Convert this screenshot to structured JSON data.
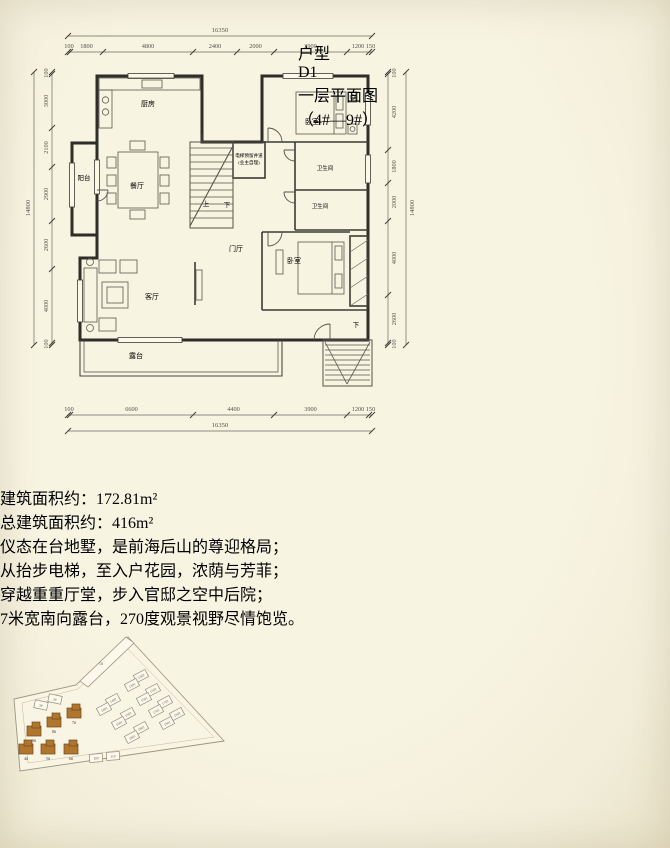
{
  "header": {
    "category": "户型",
    "unit": "D1",
    "title": "一层平面图",
    "subtitle": "（4#—9#）"
  },
  "colors": {
    "band": "#bd8750",
    "accent_red": "#a33527",
    "ink": "#37352e",
    "highlight_building": "#b0762e"
  },
  "floor_plan": {
    "rooms": {
      "kitchen": "厨房",
      "bedroom1": "卧室",
      "bedroom2": "卧室",
      "dining": "餐厅",
      "living": "客厅",
      "balcony": "阳台",
      "terrace": "露台",
      "foyer": "门厅",
      "bath1": "卫生间",
      "bath2": "卫生间",
      "up": "上",
      "down1": "下",
      "down2": "下",
      "elevator1": "电梯预留井道",
      "elevator2": "(业主自理)"
    },
    "dims": {
      "top_total": "16350",
      "top": [
        "100",
        "1800",
        "4800",
        "2400",
        "2000",
        "3900",
        "1200",
        "150"
      ],
      "bottom": [
        "100",
        "6600",
        "4400",
        "3900",
        "1200",
        "150"
      ],
      "bottom_total": "16350",
      "left": [
        "100",
        "3000",
        "2100",
        "2900",
        "2600",
        "4000",
        "100"
      ],
      "left_total": "14800",
      "right": [
        "100",
        "4200",
        "1800",
        "2000",
        "4000",
        "2600",
        "100"
      ],
      "right_total": "14800"
    }
  },
  "area": {
    "line1_label": "建筑面积约：",
    "line1_value": "172.81m²",
    "line2_label": "总建筑面积约：",
    "line2_value": "416m²"
  },
  "features": [
    "仪态在台地墅，是前海后山的尊迎格局；",
    "从抬步电梯，至入户花园，浓荫与芳菲；",
    "穿越重重厅堂，步入官邸之空中后院；",
    "7米宽南向露台，270度观景视野尽情饱览。"
  ],
  "site_plan": {
    "slab_label": "1#",
    "highlighted": [
      {
        "x": 74,
        "y": 84,
        "label": "7#"
      },
      {
        "x": 54,
        "y": 93,
        "label": "8#"
      },
      {
        "x": 34,
        "y": 102,
        "label": "9#"
      },
      {
        "x": 26,
        "y": 120,
        "label": "4#"
      },
      {
        "x": 48,
        "y": 120,
        "label": "5#"
      },
      {
        "x": 71,
        "y": 120,
        "label": "6#"
      }
    ],
    "units": [
      {
        "x": 55,
        "y": 70,
        "r": 12,
        "label": "2#"
      },
      {
        "x": 41,
        "y": 76,
        "r": 12,
        "label": "3#"
      },
      {
        "x": 96,
        "y": 129,
        "r": -4,
        "label": "10#"
      },
      {
        "x": 113,
        "y": 127,
        "r": -4,
        "label": "11#"
      },
      {
        "x": 141,
        "y": 47,
        "r": -28,
        "label": "1302"
      },
      {
        "x": 132,
        "y": 56,
        "r": -28,
        "label": "1301"
      },
      {
        "x": 153,
        "y": 61,
        "r": -28,
        "label": "1502"
      },
      {
        "x": 144,
        "y": 70,
        "r": -28,
        "label": "1501"
      },
      {
        "x": 113,
        "y": 71,
        "r": -28,
        "label": "1402"
      },
      {
        "x": 104,
        "y": 80,
        "r": -28,
        "label": "1401"
      },
      {
        "x": 165,
        "y": 73,
        "r": -28,
        "label": "1702"
      },
      {
        "x": 156,
        "y": 82,
        "r": -28,
        "label": "1701"
      },
      {
        "x": 128,
        "y": 85,
        "r": -28,
        "label": "1602"
      },
      {
        "x": 119,
        "y": 94,
        "r": -28,
        "label": "1601"
      },
      {
        "x": 177,
        "y": 85,
        "r": -28,
        "label": "1902"
      },
      {
        "x": 167,
        "y": 94,
        "r": -28,
        "label": "1901"
      },
      {
        "x": 141,
        "y": 99,
        "r": -28,
        "label": "1802"
      },
      {
        "x": 132,
        "y": 108,
        "r": -28,
        "label": "1801"
      }
    ]
  }
}
